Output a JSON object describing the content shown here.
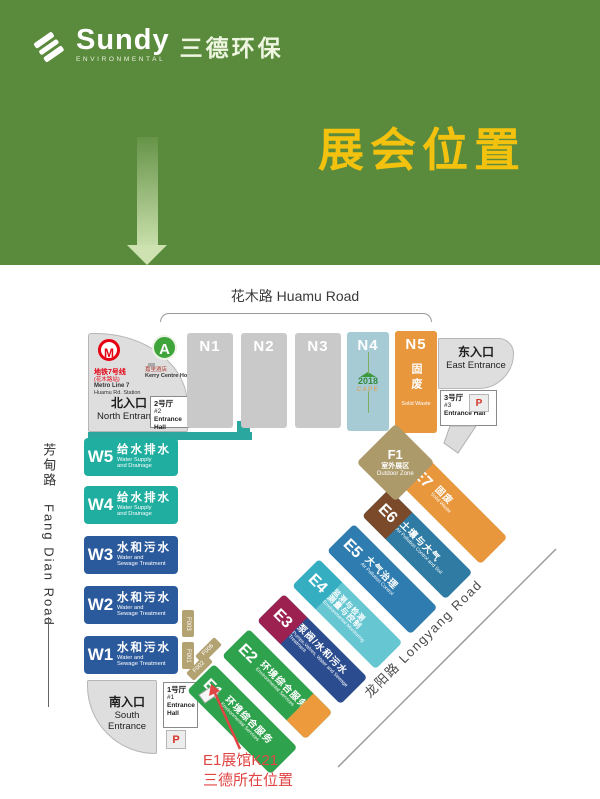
{
  "header": {
    "brand": "Sundy",
    "brand_sub": "ENVIRONMENTAL",
    "brand_cn": "三德环保",
    "title": "展会位置",
    "bg_color": "#5a8a3c",
    "title_color": "#f2c20f"
  },
  "map": {
    "roads": {
      "huamu": "花木路 Huamu Road",
      "fangdian_cn": "芳甸路",
      "fangdian_en": "Fang Dian Road",
      "longyang": "龙阳路 Longyang Road"
    },
    "north_area": {
      "metro_badge": "M",
      "metro_line_cn": "地铁7号线",
      "metro_station_cn": "(花木路站)",
      "metro_line_en": "Metro Line 7",
      "metro_station_en": "Huamu Rd. Station",
      "hotel_badge": "A",
      "hotel_cn": "嘉里酒店",
      "hotel_en": "Kerry Centre Hotel",
      "entrance_cn": "北入口",
      "entrance_en": "North Entrance",
      "hall_cn": "2号厅",
      "hall_no": "#2",
      "hall_en": "Entrance Hall"
    },
    "east_area": {
      "entrance_cn": "东入口",
      "entrance_en": "East Entrance",
      "hall_cn": "3号厅",
      "hall_no": "#3",
      "hall_en": "Entrance Hall",
      "parking": "P"
    },
    "south_area": {
      "entrance_cn": "南入口",
      "entrance_en": "South Entrance",
      "hall_cn": "1号厅",
      "hall_no": "#1",
      "hall_en": "Entrance Hall",
      "parking": "P"
    },
    "corridor_color": "#2aa8a0",
    "n_halls": [
      {
        "id": "N1",
        "color": "#c9c9c9"
      },
      {
        "id": "N2",
        "color": "#c9c9c9"
      },
      {
        "id": "N3",
        "color": "#c9c9c9"
      },
      {
        "id": "N4",
        "color": "#a6cbd4",
        "badge_year": "2018",
        "badge_label": "CAPE"
      },
      {
        "id": "N5",
        "color": "#e8973c",
        "cn": "固废",
        "en": "Solid Waste"
      }
    ],
    "w_halls": [
      {
        "id": "W5",
        "cn": "给水排水",
        "en1": "Water Supply",
        "en2": "and Drainage",
        "color": "#1fae9f"
      },
      {
        "id": "W4",
        "cn": "给水排水",
        "en1": "Water Supply",
        "en2": "and Drainage",
        "color": "#1fae9f"
      },
      {
        "id": "W3",
        "cn": "水和污水",
        "en1": "Water and",
        "en2": "Sewage Treatment",
        "color": "#2b5a9c"
      },
      {
        "id": "W2",
        "cn": "水和污水",
        "en1": "Water and",
        "en2": "Sewage Treatment",
        "color": "#2b5a9c"
      },
      {
        "id": "W1",
        "cn": "水和污水",
        "en1": "Water and",
        "en2": "Sewage Treatment",
        "color": "#2b5a9c"
      }
    ],
    "e_halls": [
      {
        "id": "E1",
        "cn": "环境综合服务",
        "en": "Environmental Services",
        "head": "#2fa24d",
        "body": "#2fa24d"
      },
      {
        "id": "E2",
        "cn": "环境综合服务",
        "en": "Environmental Services",
        "head": "#2fa24d",
        "body": "#2fa24d",
        "tip": "#ec9a3c"
      },
      {
        "id": "E3",
        "cn": "泵阀/水和污水",
        "en": "Pumps,Valves, Water and Sewage Treatment",
        "head": "#9c2150",
        "body": "#2b4c8e"
      },
      {
        "id": "E4",
        "cn": "监测与检测",
        "cn2": "测量与控制",
        "en": "Environmental Monitoring",
        "head": "#36aec2",
        "body": "#66c6d2"
      },
      {
        "id": "E5",
        "cn": "大气治理",
        "en": "Air Pollution Control",
        "head": "#2e7cb0",
        "body": "#2e7cb0"
      },
      {
        "id": "E6",
        "cn": "土壤与大气",
        "en": "Air Pollution Control and Soil",
        "head": "#7a4a2a",
        "body": "#2f7ba3"
      },
      {
        "id": "E7",
        "cn": "固废",
        "en": "Solid Waste",
        "head": "#e8973c",
        "body": "#e8973c"
      }
    ],
    "f1": {
      "id": "F1",
      "cn": "室外展区",
      "en": "Outdoor Zone",
      "color": "#ac9a6a"
    },
    "f_labels": {
      "f003": "F003",
      "f001": "F001",
      "f002": "F002",
      "f006": "F006"
    },
    "annotation": {
      "line1": "E1展馆K21",
      "line2": "三德所在位置",
      "color": "#e04545"
    }
  }
}
